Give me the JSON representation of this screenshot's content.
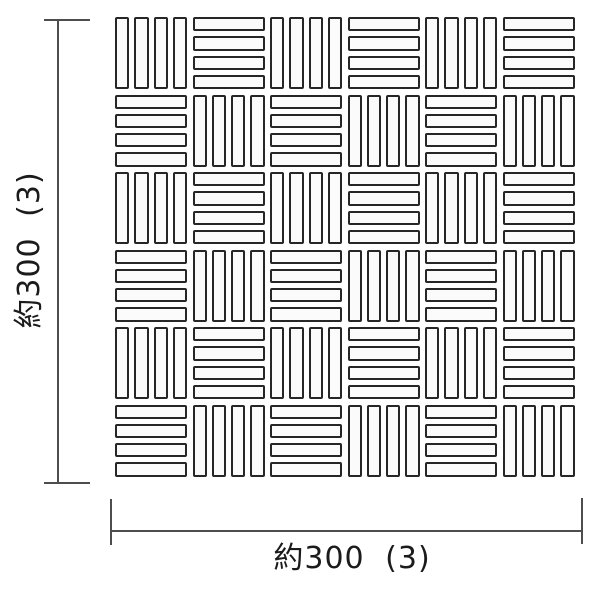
{
  "diagram": {
    "title": "mosaic-tile-sheet-dimension-drawing",
    "background_color": "#ffffff",
    "tile_grid": {
      "rows": 6,
      "cols": 6,
      "bars_per_cell": 4,
      "first_cell_orientation": "vertical",
      "pattern": "checkerboard",
      "tile_border_color": "#262626",
      "tile_fill_color": "#fbfbfb"
    },
    "dimensions": {
      "left_label": "約300 (3)",
      "bottom_label": "約300 (3)",
      "left_value": "約300",
      "left_count": "(3)",
      "bottom_value": "約300",
      "bottom_count": "(3)",
      "line_color": "#4d4d4d",
      "text_color": "#1b1b1b"
    }
  }
}
